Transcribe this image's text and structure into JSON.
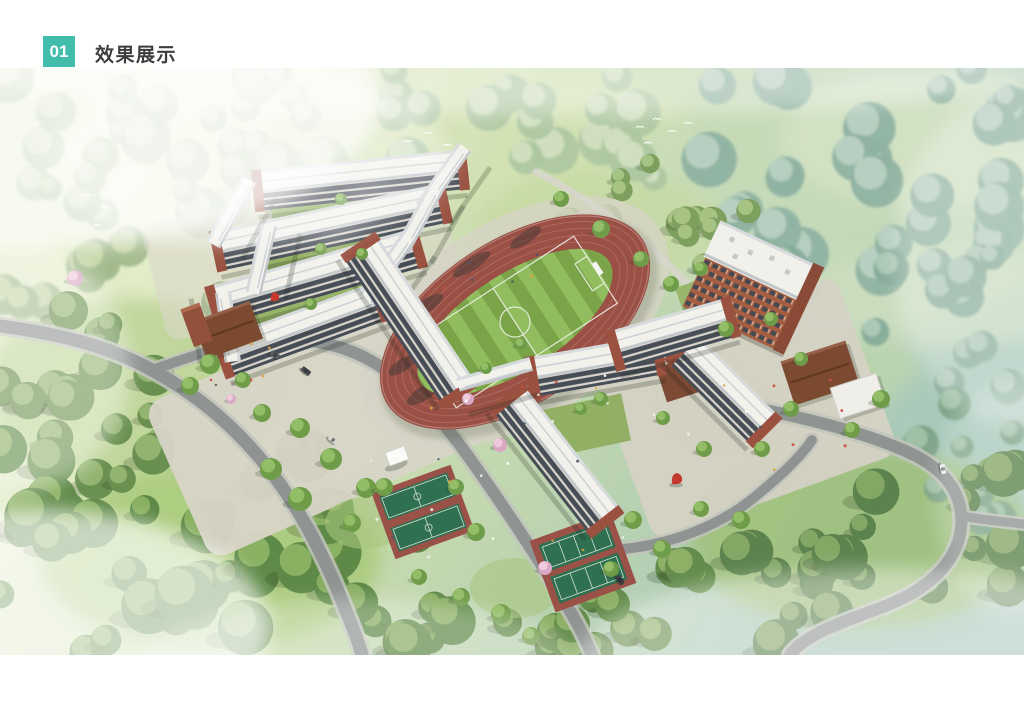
{
  "header": {
    "badge_number": "01",
    "section_title": "效果展示"
  },
  "theme": {
    "accent": "#43bdab",
    "title_color": "#3d3d3d",
    "background": "#ffffff"
  },
  "rendering": {
    "type": "aerial-architectural-rendering",
    "subject": "school campus in forested hills",
    "features": [
      "classroom buildings with white roofs and brick facades",
      "oval running track with striped soccer field",
      "dormitory tower",
      "canteen with brown roof",
      "basketball courts",
      "tennis court",
      "entrance hall",
      "winding access roads with cars",
      "surrounding forest and lawns",
      "flying birds",
      "red sculptures"
    ],
    "palette": {
      "track_red": "#9b5046",
      "field_green": "#83ac51",
      "roof_white": "#f2f1ec",
      "brick": "#934d39",
      "forest_green": "#6b9254",
      "forest_teal": "#8fb3a3",
      "road_gray": "#8f9492",
      "plaza": "#d8d5c7",
      "court_green": "#2e7050"
    }
  }
}
